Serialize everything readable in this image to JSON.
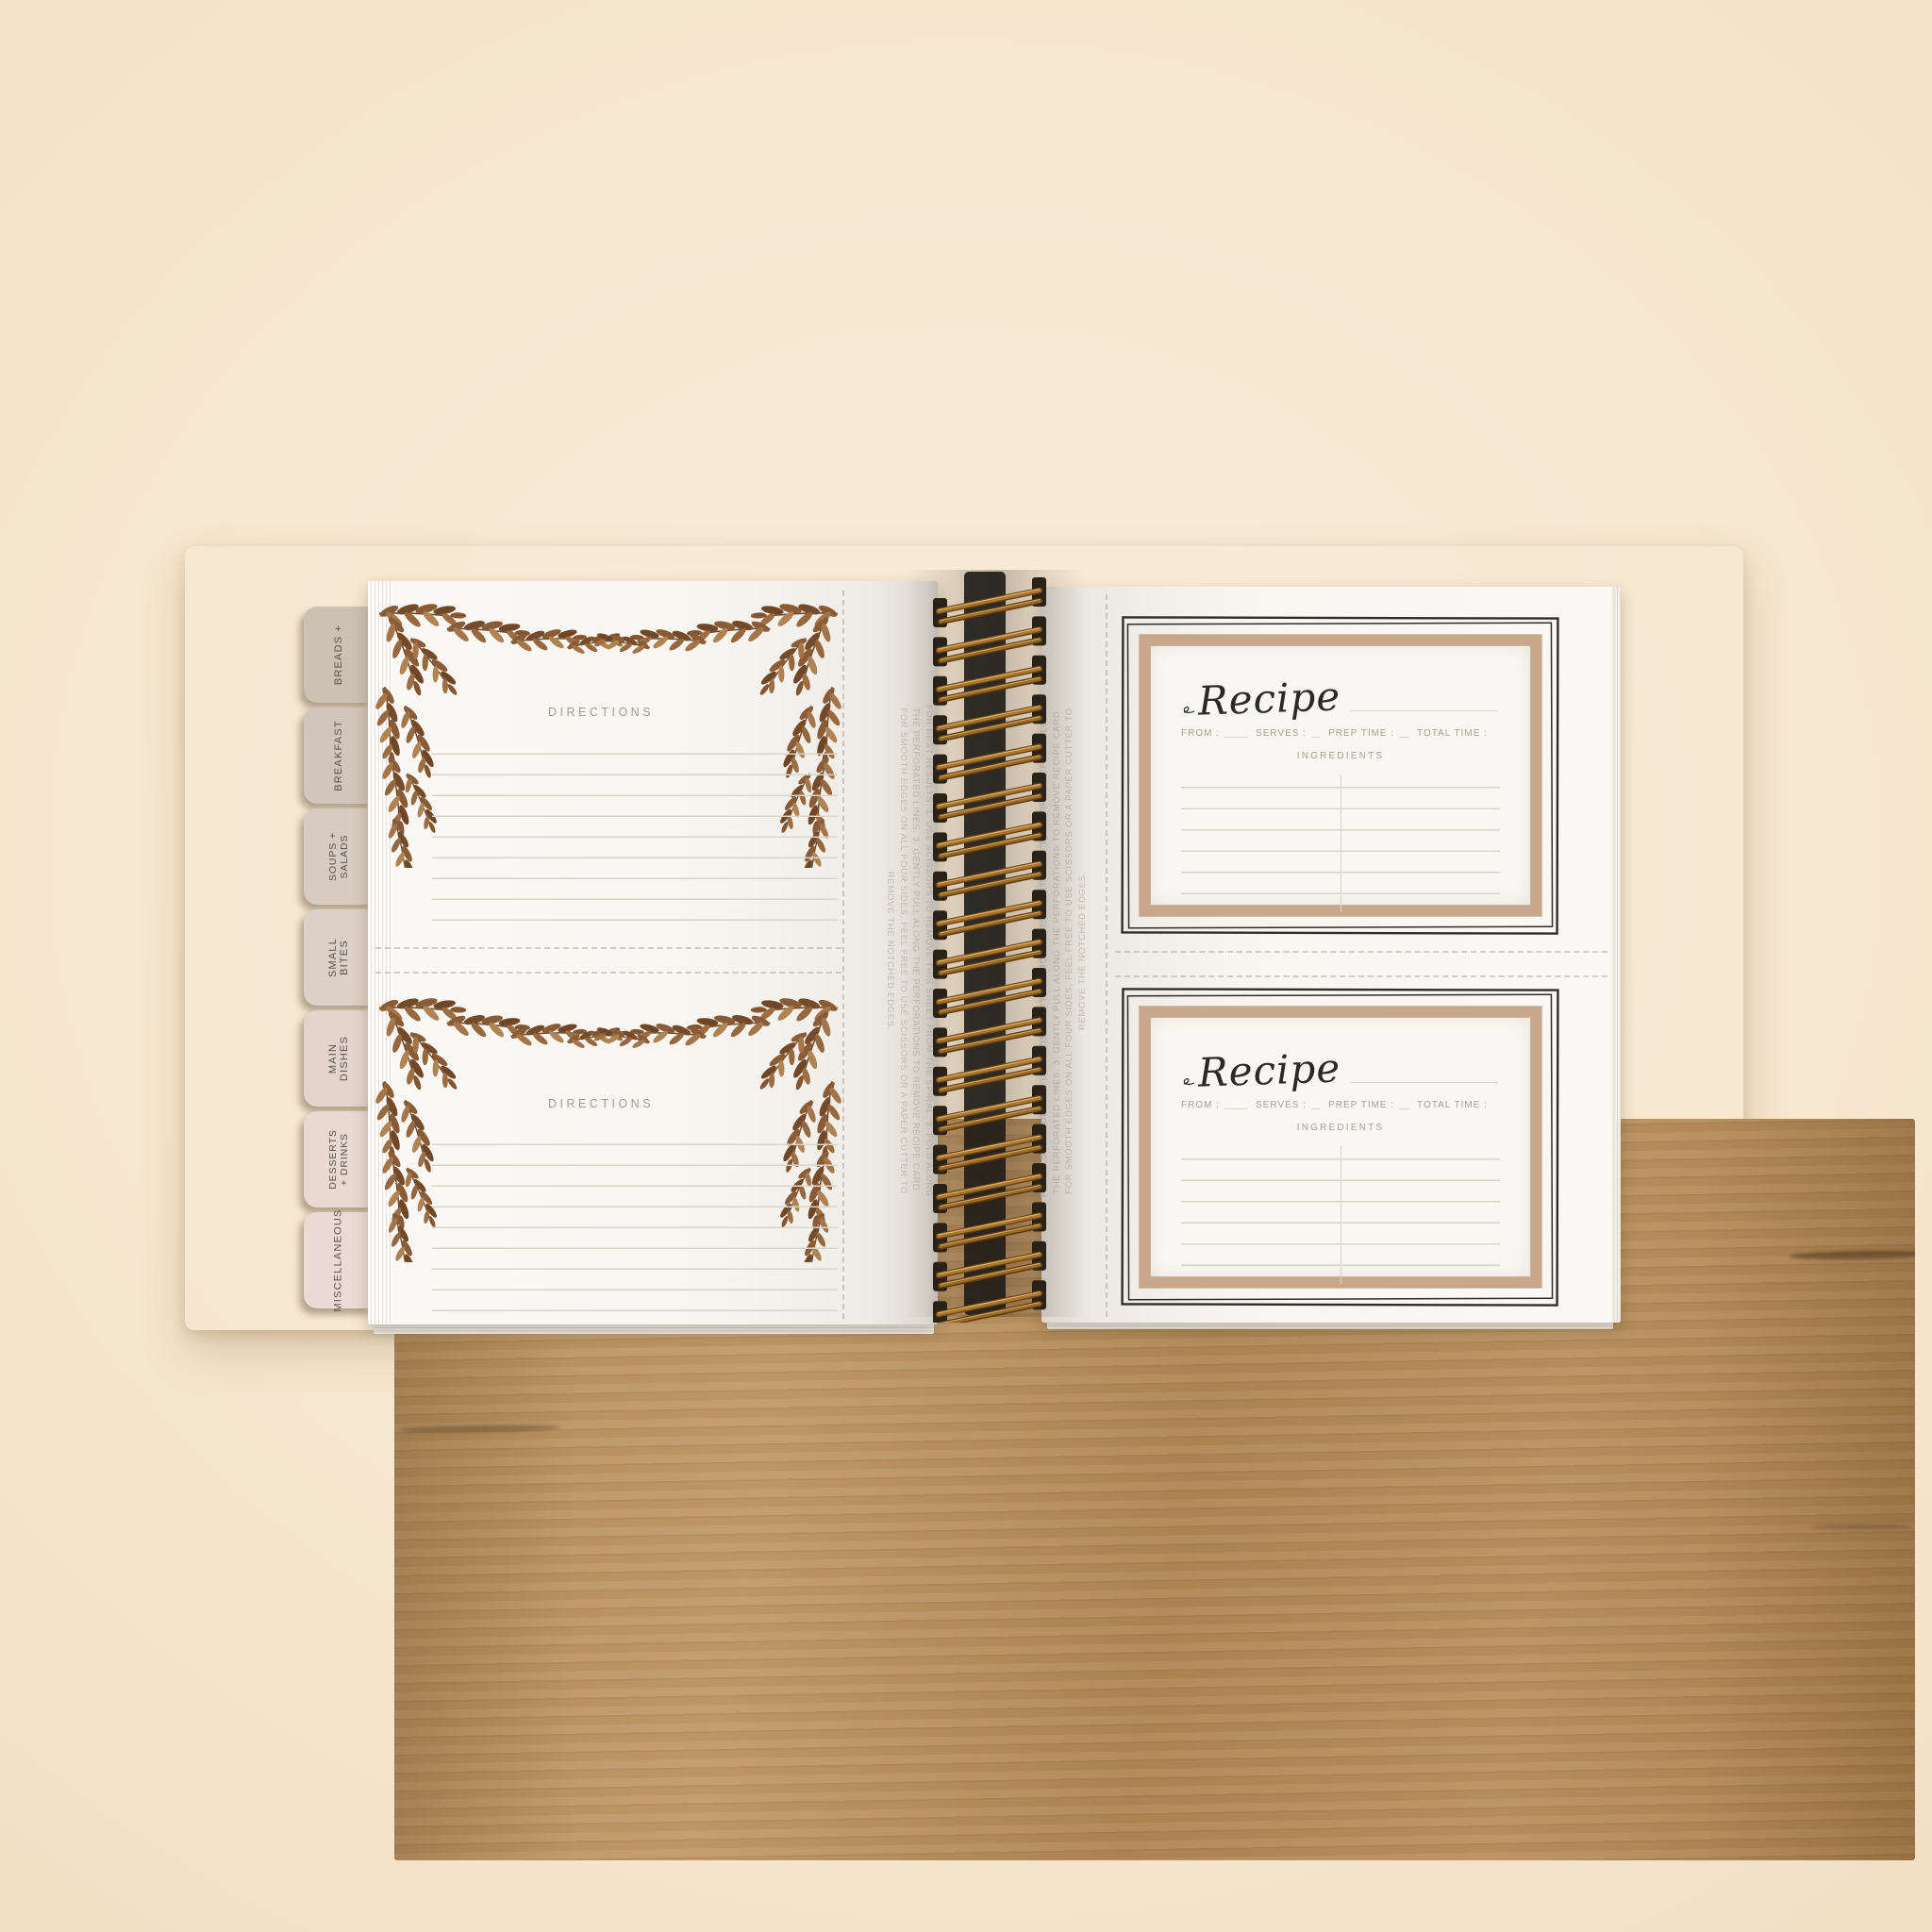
{
  "tabs": [
    {
      "label": "BREADS +"
    },
    {
      "label": "BREAKFAST"
    },
    {
      "label": "SOUPS +\nSALADS"
    },
    {
      "label": "SMALL BITES"
    },
    {
      "label": "MAIN DISHES"
    },
    {
      "label": "DESSERTS\n+ DRINKS"
    },
    {
      "label": "MISCELLANEOUS"
    }
  ],
  "left_page": {
    "cards": [
      {
        "heading": "DIRECTIONS"
      },
      {
        "heading": "DIRECTIONS"
      }
    ],
    "removal_instructions": "FOR BEST RESULTS: 1. USE SCISSORS TO REMOVE THIS SHEET FROM THE SPIRAL. 2. FOLD ALONG\nTHE PERFORATED LINES. 3. GENTLY PULL ALONG THE PERFORATIONS TO REMOVE RECIPE CARD.\nFOR SMOOTH EDGES ON ALL FOUR SIDES, FEEL FREE TO USE SCISSORS OR A PAPER CUTTER TO\nREMOVE THE NOTCHED EDGES."
  },
  "right_page": {
    "removal_instructions": "FOR BEST RESULTS: 1. USE SCISSORS TO REMOVE THIS SHEET FROM THE SPIRAL. 2. FOLD ALONG\nTHE PERFORATED LINES. 3. GENTLY PULL ALONG THE PERFORATIONS TO REMOVE RECIPE CARD.\nFOR SMOOTH EDGES ON ALL FOUR SIDES, FEEL FREE TO USE SCISSORS OR A PAPER CUTTER TO\nREMOVE THE NOTCHED EDGES.",
    "cards": [
      {
        "title": "Recipe",
        "from_label": "FROM :",
        "serves_label": "SERVES :",
        "prep_time_label": "PREP TIME :",
        "total_time_label": "TOTAL TIME :",
        "ingredients_label": "INGREDIENTS"
      },
      {
        "title": "Recipe",
        "from_label": "FROM :",
        "serves_label": "SERVES :",
        "prep_time_label": "PREP TIME :",
        "total_time_label": "TOTAL TIME :",
        "ingredients_label": "INGREDIENTS"
      }
    ]
  },
  "colors": {
    "background_cream": "#f6e7d0",
    "cover_black": "#151312",
    "wood_tan": "#b58d5b",
    "tab_taupe": "#cdc0b5",
    "tab_blush": "#eadcd4",
    "page_white": "#f7f5f0",
    "rule_line": "#d9d4ca",
    "leaf_brown": "#8a5c36",
    "frame_tan": "#c9a78a",
    "sketch_ink": "#2f2c29",
    "label_gray": "#a89f93",
    "wire_bronze": "#a8762f"
  }
}
